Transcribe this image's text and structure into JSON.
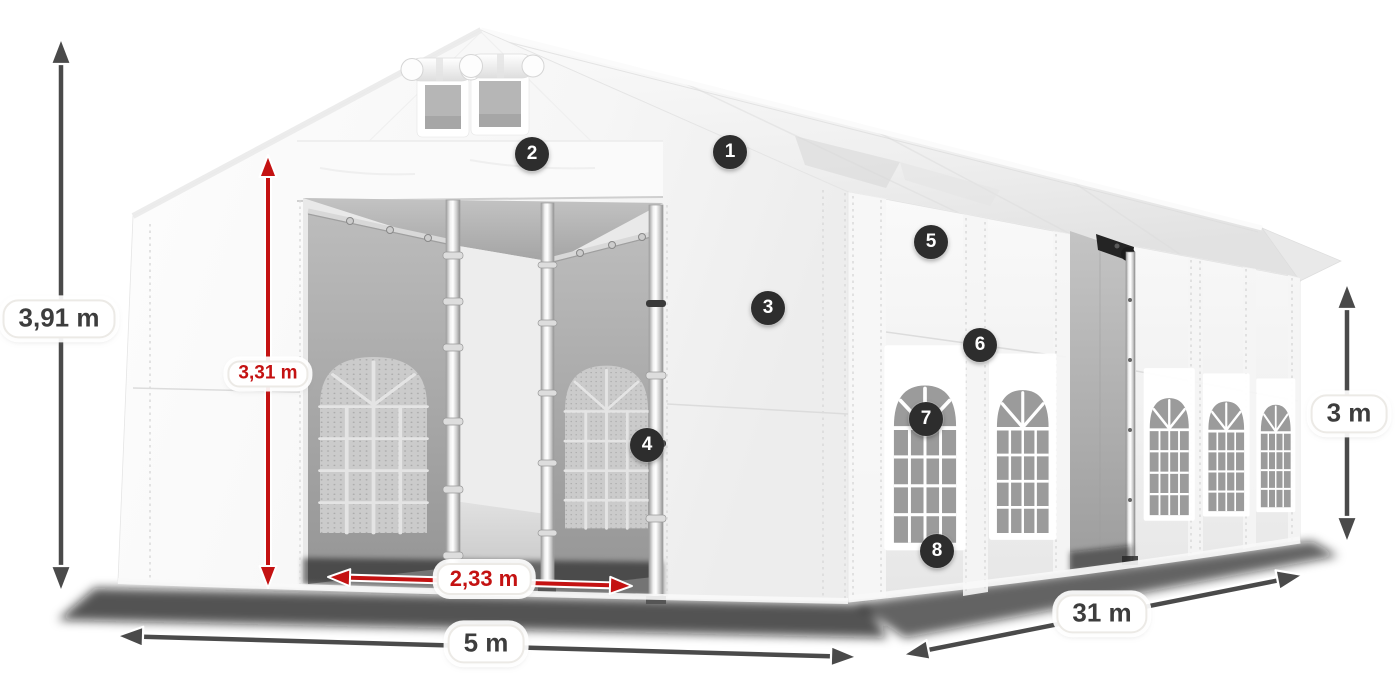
{
  "illustration": {
    "subject": "white party marquee tent with open front entrance, gable vents and arched side windows",
    "view": "three-quarter perspective, front gable left, long side wall right"
  },
  "dimensions": {
    "total_height": "3,91 m",
    "inner_height": "3,31 m",
    "entrance_width": "2,33 m",
    "front_width": "5 m",
    "length": "31 m",
    "side_height": "3 m"
  },
  "callouts": [
    "1",
    "2",
    "3",
    "4",
    "5",
    "6",
    "7",
    "8"
  ],
  "colors": {
    "dimension_red": "#c41212",
    "dimension_gray": "#4a4a4a",
    "badge_background": "#2d2d2d",
    "label_text": "#3d3d3d",
    "tent_white": "#f7f7f7",
    "window_glass": "#9b9b9b",
    "interior_gray": "#a9a9a9"
  }
}
